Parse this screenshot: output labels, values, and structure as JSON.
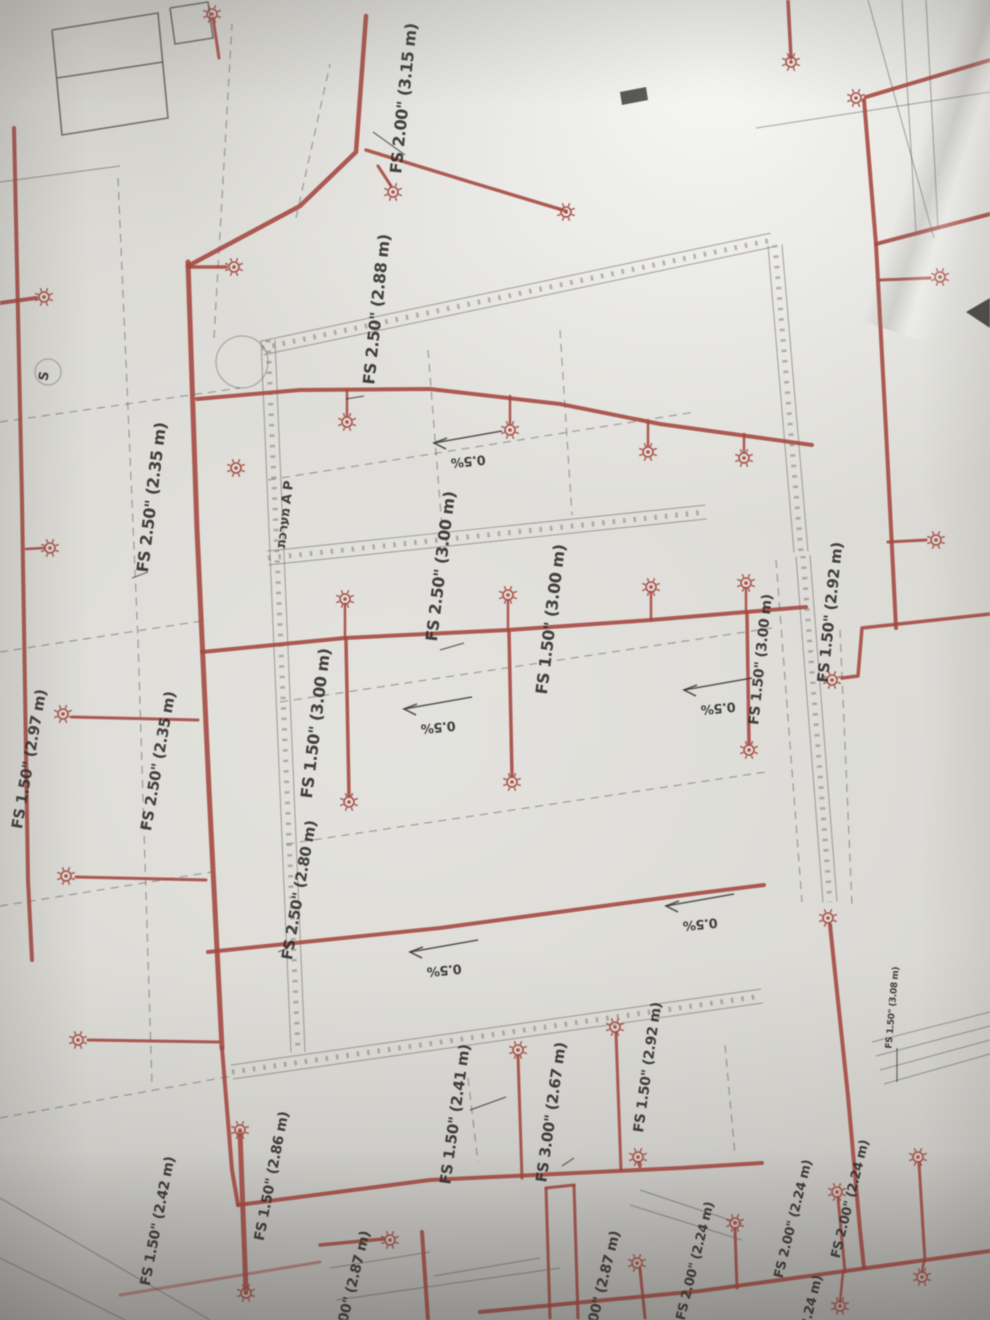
{
  "scene": {
    "description": "Photograph of a fire-sprinkler (FS) piping floor plan blueprint, taken at an angle",
    "paper_color": "#d8d7d2",
    "pipe_color": "#a4473d",
    "ink_color": "#4a4a47",
    "text_color": "#2b2a28",
    "system_label": "מערכת A P",
    "slope_label": "0.5%",
    "section_marker": "S"
  },
  "labels": [
    {
      "text": "FS 2.00\" (3.15 m)",
      "x": 409,
      "y": 99,
      "rot": -84,
      "size": 16
    },
    {
      "text": "FS 2.50\" (2.88 m)",
      "x": 382,
      "y": 310,
      "rot": -84,
      "size": 16
    },
    {
      "text": "FS 2.50\" (2.35 m)",
      "x": 157,
      "y": 498,
      "rot": -83,
      "size": 16
    },
    {
      "text": "מערכת A P",
      "x": 289,
      "y": 515,
      "rot": -83,
      "size": 13
    },
    {
      "text": "FS 2.50\" (3.00 m)",
      "x": 446,
      "y": 567,
      "rot": -83,
      "size": 16
    },
    {
      "text": "FS 1.50\" (3.00 m)",
      "x": 556,
      "y": 620,
      "rot": -83,
      "size": 16
    },
    {
      "text": "FS 1.50\" (3.00 m)",
      "x": 321,
      "y": 724,
      "rot": -83,
      "size": 16
    },
    {
      "text": "FS 1.50\" (2.97 m)",
      "x": 34,
      "y": 760,
      "rot": -80,
      "size": 15
    },
    {
      "text": "FS 2.50\" (2.35 m)",
      "x": 163,
      "y": 762,
      "rot": -80,
      "size": 15
    },
    {
      "text": "FS 1.50\" (3.00 m)",
      "x": 765,
      "y": 660,
      "rot": -84,
      "size": 14
    },
    {
      "text": "FS 1.50\" (2.92 m)",
      "x": 835,
      "y": 613,
      "rot": -84,
      "size": 15
    },
    {
      "text": "FS 2.50\" (2.80 m)",
      "x": 304,
      "y": 891,
      "rot": -80,
      "size": 15
    },
    {
      "text": "FS 1.50\" (2.41 m)",
      "x": 460,
      "y": 1115,
      "rot": -82,
      "size": 15
    },
    {
      "text": "FS 3.00\" (2.67 m)",
      "x": 556,
      "y": 1113,
      "rot": -82,
      "size": 15
    },
    {
      "text": "FS 1.50\" (2.92 m)",
      "x": 652,
      "y": 1068,
      "rot": -82,
      "size": 14
    },
    {
      "text": "FS 1.50\" (2.86 m)",
      "x": 276,
      "y": 1177,
      "rot": -79,
      "size": 14
    },
    {
      "text": "FS 1.50\" (2.42 m)",
      "x": 162,
      "y": 1222,
      "rot": -79,
      "size": 14
    },
    {
      "text": "FS 2.00\" (2.87 m)",
      "x": 354,
      "y": 1296,
      "rot": -76,
      "size": 14
    },
    {
      "text": "FS 3.00\" (2.87 m)",
      "x": 604,
      "y": 1296,
      "rot": -76,
      "size": 14
    },
    {
      "text": "FS 2.00\" (2.24 m)",
      "x": 699,
      "y": 1262,
      "rot": -76,
      "size": 13
    },
    {
      "text": "FS 2.00\" (2.24 m)",
      "x": 797,
      "y": 1220,
      "rot": -76,
      "size": 13
    },
    {
      "text": "FS 2.00\" (2.24 m)",
      "x": 854,
      "y": 1200,
      "rot": -76,
      "size": 13
    },
    {
      "text": "(2.24 m)",
      "x": 815,
      "y": 1305,
      "rot": -76,
      "size": 13
    },
    {
      "text": "FS 1.50\" (3.08 m)",
      "x": 895,
      "y": 1008,
      "rot": -85,
      "size": 9
    },
    {
      "text": "FS 1.50\"",
      "x": -10,
      "y": 520,
      "rot": -83,
      "size": 14
    }
  ],
  "slope_markers": [
    {
      "text": "0.5%",
      "x": 466,
      "y": 437
    },
    {
      "text": "0.5%",
      "x": 436,
      "y": 703
    },
    {
      "text": "0.5%",
      "x": 716,
      "y": 684
    },
    {
      "text": "0.5%",
      "x": 698,
      "y": 900
    },
    {
      "text": "0.5%",
      "x": 442,
      "y": 946
    }
  ],
  "pipes": [
    {
      "pts": [
        [
          188,
          262
        ],
        [
          197,
          530
        ],
        [
          209,
          790
        ],
        [
          222,
          1048
        ]
      ],
      "w": 5
    },
    {
      "pts": [
        [
          188,
          267
        ],
        [
          226,
          267
        ]
      ],
      "w": 3.5
    },
    {
      "pts": [
        [
          0,
          303
        ],
        [
          36,
          298
        ]
      ],
      "w": 4
    },
    {
      "pts": [
        [
          188,
          266
        ],
        [
          300,
          206
        ],
        [
          356,
          152
        ],
        [
          366,
          16
        ]
      ],
      "w": 4.5
    },
    {
      "pts": [
        [
          378,
          166
        ],
        [
          391,
          186
        ]
      ],
      "w": 3
    },
    {
      "pts": [
        [
          366,
          150
        ],
        [
          470,
          182
        ],
        [
          566,
          211
        ]
      ],
      "w": 3.5
    },
    {
      "pts": [
        [
          990,
          60
        ],
        [
          866,
          97
        ]
      ],
      "w": 4
    },
    {
      "pts": [
        [
          788,
          0
        ],
        [
          791,
          58
        ]
      ],
      "w": 3.5
    },
    {
      "pts": [
        [
          864,
          100
        ],
        [
          876,
          244
        ],
        [
          990,
          214
        ]
      ],
      "w": 4
    },
    {
      "pts": [
        [
          876,
          244
        ],
        [
          886,
          430
        ],
        [
          892,
          548
        ],
        [
          896,
          628
        ]
      ],
      "w": 4
    },
    {
      "pts": [
        [
          880,
          280
        ],
        [
          930,
          278
        ]
      ],
      "w": 3
    },
    {
      "pts": [
        [
          888,
          542
        ],
        [
          926,
          540
        ]
      ],
      "w": 3
    },
    {
      "pts": [
        [
          197,
          399
        ],
        [
          300,
          390
        ],
        [
          430,
          389
        ],
        [
          560,
          404
        ],
        [
          660,
          424
        ],
        [
          812,
          445
        ]
      ],
      "w": 4
    },
    {
      "pts": [
        [
          347,
          390
        ],
        [
          347,
          416
        ]
      ],
      "w": 2.5
    },
    {
      "pts": [
        [
          510,
          396
        ],
        [
          510,
          424
        ]
      ],
      "w": 2.5
    },
    {
      "pts": [
        [
          648,
          422
        ],
        [
          648,
          446
        ]
      ],
      "w": 2.5
    },
    {
      "pts": [
        [
          744,
          434
        ],
        [
          744,
          452
        ]
      ],
      "w": 2.5
    },
    {
      "pts": [
        [
          202,
          652
        ],
        [
          345,
          638
        ],
        [
          508,
          630
        ],
        [
          651,
          620
        ],
        [
          746,
          612
        ],
        [
          806,
          607
        ]
      ],
      "w": 4
    },
    {
      "pts": [
        [
          345,
          638
        ],
        [
          345,
          604
        ]
      ],
      "w": 2.5
    },
    {
      "pts": [
        [
          508,
          630
        ],
        [
          508,
          600
        ]
      ],
      "w": 2.5
    },
    {
      "pts": [
        [
          651,
          620
        ],
        [
          651,
          592
        ]
      ],
      "w": 2.5
    },
    {
      "pts": [
        [
          746,
          612
        ],
        [
          746,
          588
        ]
      ],
      "w": 2.5
    },
    {
      "pts": [
        [
          346,
          640
        ],
        [
          349,
          796
        ]
      ],
      "w": 3.5
    },
    {
      "pts": [
        [
          509,
          632
        ],
        [
          512,
          776
        ]
      ],
      "w": 3.5
    },
    {
      "pts": [
        [
          747,
          613
        ],
        [
          749,
          744
        ]
      ],
      "w": 3.5
    },
    {
      "pts": [
        [
          208,
          952
        ],
        [
          440,
          928
        ],
        [
          700,
          893
        ],
        [
          764,
          885
        ]
      ],
      "w": 4
    },
    {
      "pts": [
        [
          198,
          720
        ],
        [
          72,
          717
        ]
      ],
      "w": 3
    },
    {
      "pts": [
        [
          206,
          880
        ],
        [
          76,
          877
        ]
      ],
      "w": 3
    },
    {
      "pts": [
        [
          219,
          1042
        ],
        [
          88,
          1040
        ]
      ],
      "w": 3
    },
    {
      "pts": [
        [
          14,
          128
        ],
        [
          22,
          500
        ],
        [
          28,
          880
        ],
        [
          32,
          960
        ]
      ],
      "w": 4
    },
    {
      "pts": [
        [
          26,
          549
        ],
        [
          44,
          548
        ]
      ],
      "w": 2.5
    },
    {
      "pts": [
        [
          842,
          678
        ],
        [
          858,
          676
        ],
        [
          862,
          628
        ],
        [
          990,
          614
        ]
      ],
      "w": 3.5
    },
    {
      "pts": [
        [
          830,
          925
        ],
        [
          848,
          1096
        ],
        [
          860,
          1230
        ],
        [
          864,
          1268
        ]
      ],
      "w": 4
    },
    {
      "pts": [
        [
          238,
          1205
        ],
        [
          430,
          1180
        ],
        [
          680,
          1168
        ],
        [
          762,
          1163
        ]
      ],
      "w": 4
    },
    {
      "pts": [
        [
          222,
          1048
        ],
        [
          232,
          1170
        ],
        [
          238,
          1205
        ]
      ],
      "w": 4
    },
    {
      "pts": [
        [
          522,
          1178
        ],
        [
          518,
          1056
        ]
      ],
      "w": 3
    },
    {
      "pts": [
        [
          621,
          1170
        ],
        [
          616,
          1033
        ]
      ],
      "w": 3
    },
    {
      "pts": [
        [
          640,
          1167
        ],
        [
          638,
          1162
        ]
      ],
      "w": 2.5
    },
    {
      "pts": [
        [
          240,
          1132
        ],
        [
          246,
          1292
        ]
      ],
      "w": 5
    },
    {
      "pts": [
        [
          120,
          1295
        ],
        [
          320,
          1262
        ]
      ],
      "w": 3,
      "o": 0.5
    },
    {
      "pts": [
        [
          480,
          1312
        ],
        [
          700,
          1291
        ],
        [
          940,
          1258
        ],
        [
          990,
          1251
        ]
      ],
      "w": 4
    },
    {
      "pts": [
        [
          737,
          1288
        ],
        [
          735,
          1229
        ]
      ],
      "w": 3
    },
    {
      "pts": [
        [
          845,
          1272
        ],
        [
          838,
          1198
        ]
      ],
      "w": 3
    },
    {
      "pts": [
        [
          925,
          1261
        ],
        [
          919,
          1163
        ]
      ],
      "w": 3
    },
    {
      "pts": [
        [
          843,
          1272
        ],
        [
          840,
          1302
        ]
      ],
      "w": 2.5
    },
    {
      "pts": [
        [
          924,
          1261
        ],
        [
          922,
          1272
        ]
      ],
      "w": 2.5
    },
    {
      "pts": [
        [
          546,
          1188
        ],
        [
          550,
          1318
        ]
      ],
      "w": 3
    },
    {
      "pts": [
        [
          574,
          1185
        ],
        [
          578,
          1318
        ]
      ],
      "w": 3
    },
    {
      "pts": [
        [
          546,
          1188
        ],
        [
          574,
          1185
        ]
      ],
      "w": 3
    },
    {
      "pts": [
        [
          640,
          1269
        ],
        [
          645,
          1318
        ]
      ],
      "w": 3
    },
    {
      "pts": [
        [
          320,
          1245
        ],
        [
          384,
          1239
        ]
      ],
      "w": 3.5
    },
    {
      "pts": [
        [
          422,
          1232
        ],
        [
          428,
          1320
        ]
      ],
      "w": 4
    },
    {
      "pts": [
        [
          213,
          18
        ],
        [
          219,
          58
        ]
      ],
      "w": 3
    }
  ],
  "sprinklers": [
    [
      212,
      14
    ],
    [
      234,
      267
    ],
    [
      44,
      297
    ],
    [
      50,
      548
    ],
    [
      393,
      192
    ],
    [
      566,
      212
    ],
    [
      791,
      62
    ],
    [
      856,
      98
    ],
    [
      940,
      277
    ],
    [
      936,
      540
    ],
    [
      347,
      422
    ],
    [
      510,
      430
    ],
    [
      648,
      452
    ],
    [
      744,
      458
    ],
    [
      236,
      468
    ],
    [
      345,
      599
    ],
    [
      508,
      595
    ],
    [
      651,
      587
    ],
    [
      746,
      583
    ],
    [
      832,
      680
    ],
    [
      349,
      802
    ],
    [
      512,
      782
    ],
    [
      749,
      750
    ],
    [
      63,
      714
    ],
    [
      66,
      876
    ],
    [
      78,
      1040
    ],
    [
      828,
      918
    ],
    [
      518,
      1050
    ],
    [
      615,
      1027
    ],
    [
      638,
      1157
    ],
    [
      240,
      1130
    ],
    [
      246,
      1293
    ],
    [
      637,
      1263
    ],
    [
      735,
      1223
    ],
    [
      390,
      1240
    ],
    [
      837,
      1192
    ],
    [
      918,
      1157
    ],
    [
      840,
      1306
    ],
    [
      922,
      1277
    ]
  ],
  "bands": [
    [
      268,
      340,
      298,
      1052
    ],
    [
      268,
      558,
      706,
      512
    ],
    [
      262,
      348,
      772,
      240
    ],
    [
      775,
      245,
      801,
      552
    ],
    [
      232,
      1072,
      762,
      996
    ],
    [
      803,
      556,
      830,
      902
    ]
  ],
  "dashed": [
    [
      118,
      178,
      138,
      640
    ],
    [
      138,
      640,
      152,
      1085
    ],
    [
      0,
      422,
      240,
      388
    ],
    [
      0,
      652,
      208,
      620
    ],
    [
      0,
      906,
      212,
      872
    ],
    [
      0,
      1118,
      232,
      1076
    ],
    [
      268,
      480,
      695,
      412
    ],
    [
      280,
      702,
      772,
      628
    ],
    [
      286,
      844,
      766,
      772
    ],
    [
      776,
      560,
      802,
      902
    ],
    [
      428,
      350,
      442,
      528
    ],
    [
      560,
      330,
      572,
      515
    ],
    [
      296,
      218,
      330,
      64
    ],
    [
      840,
      630,
      852,
      905
    ],
    [
      214,
      338,
      232,
      24
    ],
    [
      468,
      1078,
      478,
      1162
    ],
    [
      725,
      1045,
      735,
      1155
    ]
  ],
  "gray_lines": [
    [
      872,
      1042,
      990,
      1012
    ],
    [
      876,
      1056,
      990,
      1026
    ],
    [
      880,
      1070,
      990,
      1040
    ],
    [
      884,
      1084,
      990,
      1054
    ],
    [
      902,
      0,
      916,
      232
    ],
    [
      926,
      0,
      938,
      228
    ],
    [
      868,
      0,
      934,
      238
    ],
    [
      0,
      1198,
      210,
      1320
    ],
    [
      0,
      1258,
      125,
      1320
    ],
    [
      756,
      128,
      990,
      92
    ],
    [
      0,
      182,
      120,
      166
    ],
    [
      640,
      1190,
      742,
      1224
    ],
    [
      630,
      1205,
      742,
      1240
    ],
    [
      330,
      1268,
      430,
      1252
    ],
    [
      434,
      1276,
      540,
      1258
    ],
    [
      336,
      1300,
      560,
      1268
    ]
  ],
  "rooms": [
    [
      [
        52,
        30
      ],
      [
        158,
        13
      ],
      [
        168,
        118
      ],
      [
        62,
        135
      ],
      [
        52,
        30
      ]
    ],
    [
      [
        57,
        78
      ],
      [
        163,
        62
      ]
    ],
    [
      [
        170,
        8
      ],
      [
        208,
        2
      ],
      [
        213,
        38
      ],
      [
        175,
        44
      ],
      [
        170,
        8
      ]
    ]
  ],
  "circles": [
    [
      242,
      362,
      26
    ],
    [
      48,
      372,
      13
    ]
  ],
  "black_box": [
    [
      620,
      92
    ],
    [
      646,
      87
    ],
    [
      648,
      100
    ],
    [
      622,
      105
    ]
  ],
  "edge_triangle": [
    [
      990,
      298
    ],
    [
      966,
      312
    ],
    [
      990,
      328
    ]
  ],
  "leaders": [
    [
      405,
      155,
      373,
      132
    ],
    [
      364,
      396,
      346,
      399
    ],
    [
      148,
      572,
      132,
      578
    ],
    [
      440,
      650,
      464,
      643
    ],
    [
      288,
      948,
      278,
      952
    ],
    [
      470,
      1110,
      506,
      1097
    ],
    [
      562,
      1166,
      574,
      1158
    ],
    [
      897,
      1048,
      897,
      1082
    ]
  ],
  "s_marker": {
    "text": "S",
    "x": 48,
    "y": 372,
    "rot": -80
  }
}
